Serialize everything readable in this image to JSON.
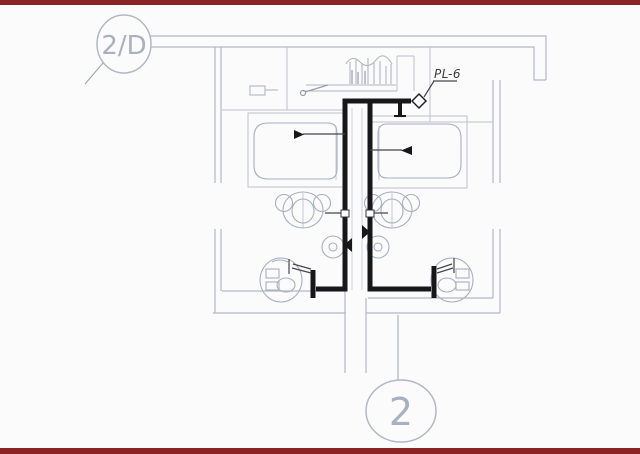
{
  "page": {
    "background": "#fbfbfc",
    "accent_bar_color": "#8b2224",
    "description": "Plumbing riser detail plan drawing with grid reference bubbles"
  },
  "drawing": {
    "title_bubble": {
      "label": "2/D"
    },
    "grid_bubble": {
      "label": "2"
    },
    "pipe_label": {
      "text": "PL-6"
    },
    "colors": {
      "wall": "#b3b8c5",
      "partition": "#bcc1cc",
      "fixture_sketch": "#a9afbf",
      "pipe": "#17171a",
      "thin_pipe": "#46464c",
      "label_text": "#3a3a40",
      "bubble_text": "#aab0bf",
      "accent_bar": "#8b2224"
    },
    "fixtures": [
      {
        "name": "bathtub-left"
      },
      {
        "name": "bathtub-right"
      },
      {
        "name": "toilet-left"
      },
      {
        "name": "toilet-right"
      },
      {
        "name": "floor-drain-left"
      },
      {
        "name": "floor-drain-right"
      },
      {
        "name": "lavatory-left"
      },
      {
        "name": "lavatory-right"
      },
      {
        "name": "counter-fixture-top"
      }
    ],
    "symbols": [
      {
        "name": "check-valve-diamond"
      },
      {
        "name": "flow-arrows"
      },
      {
        "name": "riser-caps"
      }
    ]
  }
}
